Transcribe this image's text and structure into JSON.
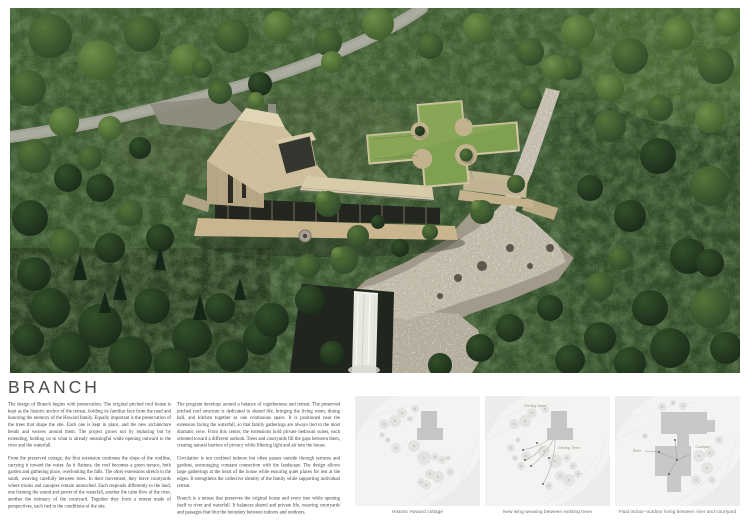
{
  "title": "BRANCH",
  "essay": {
    "col1": [
      "The design of Branch begins with preservation. The original pitched roof house is kept as the historic anchor of the retreat, holding its familiar face from the road and honoring the memory of the Howard family. Equally important is the preservation of the trees that shape the site. Each one is kept in place, and the new architecture bends and weaves around them. The project grows not by replacing but by extending, holding on to what is already meaningful while opening outward to the river and the waterfall.",
      "From the preserved cottage, the first extension continues the slope of the roofline, carrying it toward the water. As it flattens, the roof becomes a green terrace, both garden and gathering place, overlooking the falls. The other extensions stretch to the south, weaving carefully between trees. In their movement, they leave courtyards where trunks and canopies remain untouched. Each responds differently to the land, one framing the sound and power of the waterfall, another the calm flow of the river, another the intimacy of the courtyard. Together they form a retreat made of perspectives, each tied to the conditions of the site."
    ],
    "col2": [
      "The program develops around a balance of togetherness and retreat. The preserved pitched roof structure is dedicated to shared life, bringing the living room, dining hall, and kitchen together as one continuous space. It is positioned near the extension facing the waterfall, so that family gatherings are always tied to the most dramatic view. From this center, the extensions hold private bedroom suites, each oriented toward a different outlook. Trees and courtyards fill the gaps between them, creating natural barriers of privacy while filtering light and air into the house.",
      "Circulation is not confined indoors but often passes outside through terraces and gardens, encouraging constant connection with the landscape. The design allows large gatherings at the heart of the house while ensuring quiet places for rest at the edges. It strengthens the collective identity of the family while supporting individual retreat.",
      "Branch is a retreat that preserves the original house and every tree while opening itself to river and waterfall. It balances shared and private life, weaving courtyards and passages that blur the boundary between indoors and outdoors."
    ]
  },
  "diagrams": [
    {
      "caption": "Historic Howard cottage",
      "labels": []
    },
    {
      "caption": "New wing weaving between existing trees",
      "labels": [
        "Existing Trees",
        "Existing Trees"
      ]
    },
    {
      "caption": "Fluid indoor–outdoor living between river and courtyard",
      "labels": [
        "River",
        "Courtyard"
      ]
    }
  ],
  "render": {
    "colors": {
      "forest_base": "#35502c",
      "road": "#a6a69c",
      "wood_roof": "#cfc09d",
      "wood_wall": "#b7a885",
      "green_roof": "#7fa050",
      "river": "#c2bbaa",
      "river_bank": "#a29a8a",
      "cliff": "#20251d",
      "waterfall": "#e8e8e0"
    }
  }
}
